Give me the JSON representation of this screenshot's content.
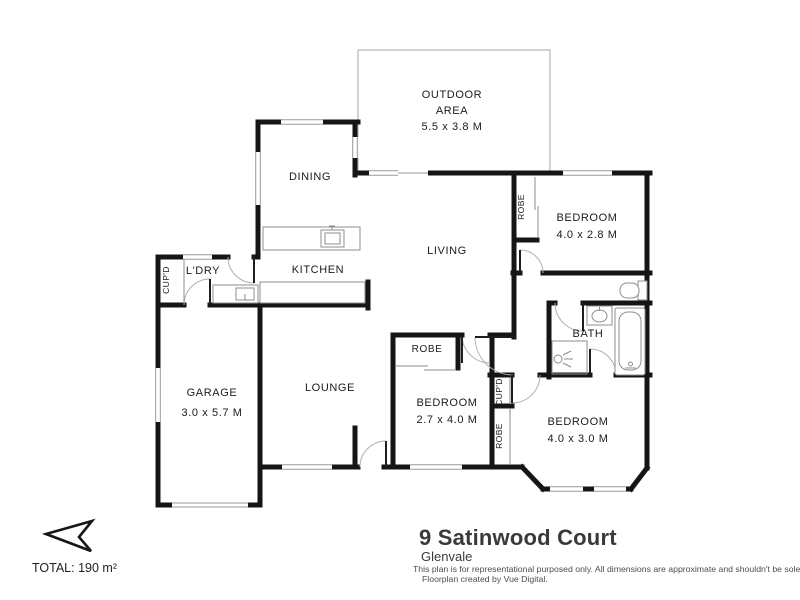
{
  "floorplan": {
    "rooms": {
      "outdoor": {
        "name_line1": "OUTDOOR",
        "name_line2": "AREA",
        "dims": "5.5 x 3.8 M"
      },
      "dining": {
        "name": "DINING"
      },
      "living": {
        "name": "LIVING"
      },
      "kitchen": {
        "name": "KITCHEN"
      },
      "laundry": {
        "name": "L'DRY"
      },
      "laundry_cupboard": {
        "name": "CUP'D"
      },
      "garage": {
        "name": "GARAGE",
        "dims": "3.0 x 5.7 M"
      },
      "lounge": {
        "name": "LOUNGE"
      },
      "bedroom1": {
        "name": "BEDROOM",
        "dims": "4.0 x 2.8 M"
      },
      "bedroom1_robe": {
        "name": "ROBE"
      },
      "bath": {
        "name": "BATH"
      },
      "bedroom2": {
        "name": "BEDROOM",
        "dims": "4.0 x 3.0 M"
      },
      "bedroom3": {
        "name": "BEDROOM",
        "dims": "2.7 x 4.0 M"
      },
      "bedroom3_robe": {
        "name": "ROBE"
      },
      "hall_cupboard": {
        "name": "CUP'D"
      },
      "hall_robe": {
        "name": "ROBE"
      }
    },
    "total_area": "TOTAL: 190 m²"
  },
  "title_block": {
    "address": "9 Satinwood Court",
    "suburb": "Glenvale",
    "disclaimer_line1": "This plan is for representational purposed only. All dimensions are approximate and shouldn't be solely relied upon.",
    "disclaimer_line2": "Floorplan created by Vue Digital."
  },
  "colors": {
    "wall": "#151515",
    "window_line": "#9a9a9a",
    "fixture_line": "#8d8d8d",
    "text": "#1b1b1b"
  }
}
